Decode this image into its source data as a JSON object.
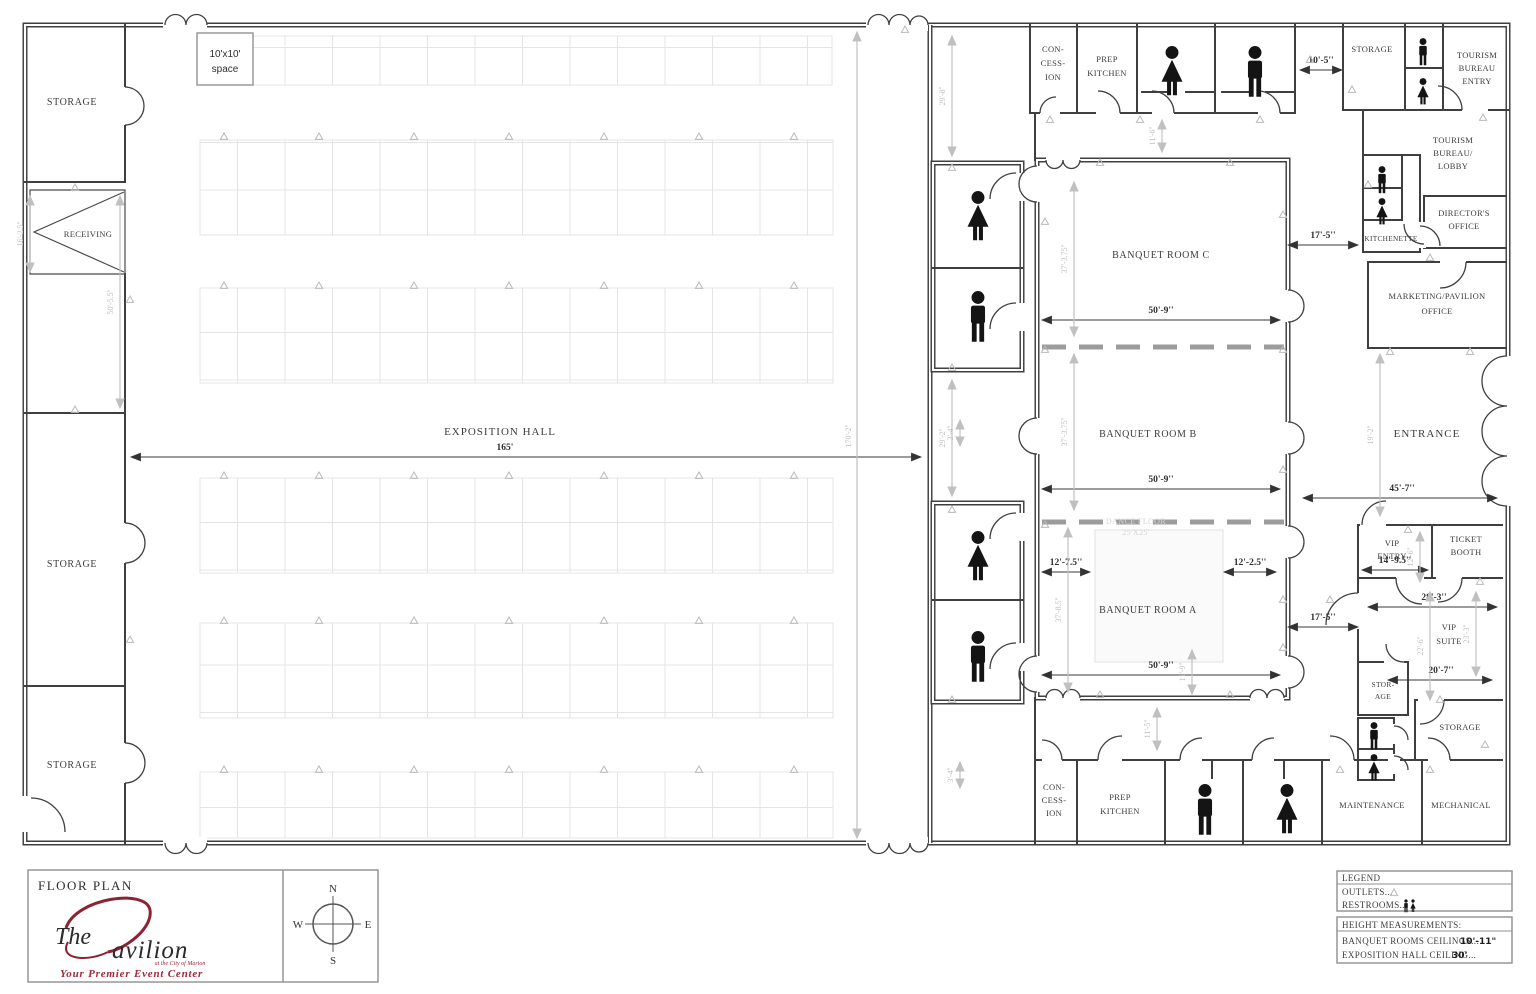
{
  "rooms": {
    "storage": "STORAGE",
    "receiving": "RECEIVING",
    "exposition_hall": "EXPOSITION HALL",
    "space1": "10'x10'",
    "space2": "space",
    "con1": "CON-",
    "con2": "CESS-",
    "con3": "ION",
    "prep1": "PREP",
    "prep2": "KITCHEN",
    "tbe1": "TOURISM",
    "tbe2": "BUREAU",
    "tbe3": "ENTRY",
    "tbl1": "TOURISM",
    "tbl2": "BUREAU/",
    "tbl3": "LOBBY",
    "kitchenette": "KITCHENETTE",
    "dir1": "DIRECTOR'S",
    "dir2": "OFFICE",
    "mkt1": "MARKETING/PAVILION",
    "mkt2": "OFFICE",
    "banquet_c": "BANQUET ROOM C",
    "banquet_b": "BANQUET ROOM B",
    "banquet_a": "BANQUET ROOM A",
    "dance1": "DANCE FLOOR",
    "dance2": "25'X25'",
    "entrance": "ENTRANCE",
    "vip1": "VIP",
    "vip2": "ENTRY",
    "tkt1": "TICKET",
    "tkt2": "BOOTH",
    "vips1": "VIP",
    "vips2": "SUITE",
    "stor1": "STOR-",
    "stor2": "AGE",
    "maintenance": "MAINTENANCE",
    "mechanical": "MECHANICAL"
  },
  "dims": {
    "expo_width": "165'",
    "expo_height": "170'-2''",
    "receiving_height": "16'-2.5''",
    "left_alcove": "50'-5.5''",
    "top_corridor": "29'-8''",
    "mid_corridor": "29'-2''",
    "gap_top": "11'-6''",
    "gap_bottom": "11'-5''",
    "d10_5": "10'-5''",
    "banquet_c_w": "50'-9''",
    "banquet_b_w": "50'-9''",
    "banquet_a_w": "50'-9''",
    "banquet_c_h": "37'-3.75''",
    "banquet_b_h": "37'-3.75''",
    "banquet_a_h": "37'-8.5''",
    "banquet_a_inner": "11'-9''",
    "d17_5_top": "17'-5''",
    "d17_5_bot": "17'-5''",
    "d12_7_5": "12'-7.5''",
    "d12_2_5": "12'-2.5''",
    "d45_7": "45'-7''",
    "entrance_h": "19'-2''",
    "d14_9_5": "14'-9.5''",
    "vip_entry_h": "12'-6''",
    "d28_3": "28'-3''",
    "vip_suite_h1": "22'-6''",
    "vip_suite_h2": "23'-3''",
    "d20_7": "20'-7''",
    "small_a": "3'-4''",
    "small_b": "3'-4''"
  },
  "legend": {
    "title": "LEGEND",
    "outlets": "OUTLETS...",
    "restrooms": "RESTROOMS...",
    "height_title": "HEIGHT MEASUREMENTS:",
    "banquet_ceiling_label": "BANQUET ROOMS CEILINGS...",
    "banquet_ceiling_value": "10'-11\"",
    "expo_ceiling_label": "EXPOSITION HALL CEILING...",
    "expo_ceiling_value": "30'"
  },
  "titleblock": {
    "heading": "FLOOR PLAN",
    "logo_the": "The",
    "logo_rest": "avilion",
    "logo_sub": "at the City of Marion",
    "tagline": "Your Premier Event Center"
  },
  "compass": {
    "n": "N",
    "e": "E",
    "s": "S",
    "w": "W"
  },
  "icons": {
    "outlet": "outlet-triangle",
    "man": "man-restroom-icon",
    "woman": "woman-restroom-icon"
  },
  "colors": {
    "wall": "#3f3f3f",
    "dim_gray": "#bdbdbd",
    "grid": "#e4e4e4",
    "accent_red": "#8d2332"
  }
}
